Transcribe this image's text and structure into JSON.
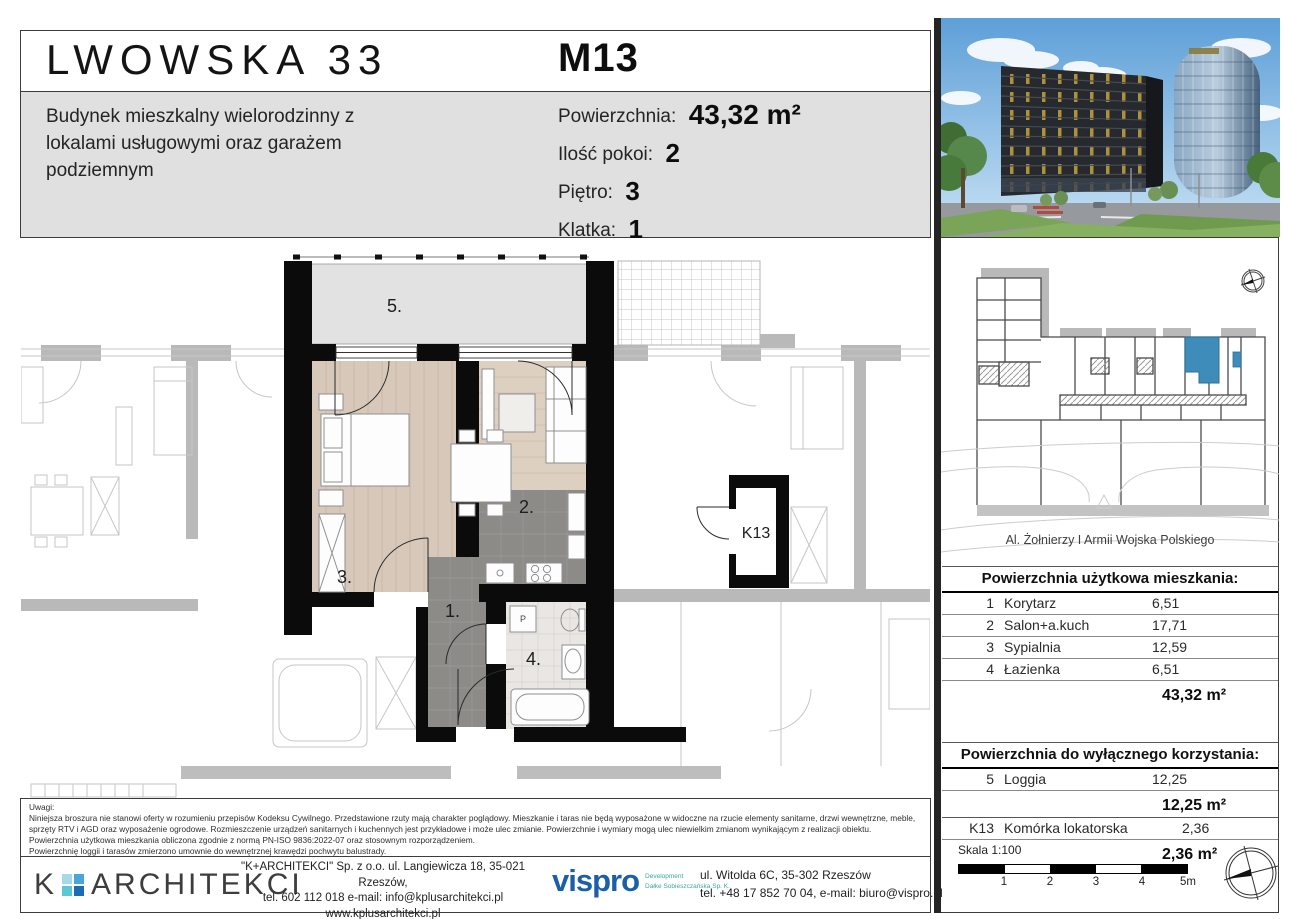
{
  "header": {
    "project_title": "LWOWSKA 33",
    "subtitle": "Budynek mieszkalny wielorodzinny z lokalami usługowymi oraz garażem podziemnym",
    "unit_id": "M13",
    "specs": [
      {
        "label": "Powierzchnia:",
        "value": "43,32 m²"
      },
      {
        "label": "Ilość pokoi:",
        "value": "2"
      },
      {
        "label": "Piętro:",
        "value": "3"
      },
      {
        "label": "Klatka:",
        "value": "1"
      }
    ]
  },
  "floor_plan": {
    "room_labels": {
      "r1": "1.",
      "r2": "2.",
      "r3": "3.",
      "r4": "4.",
      "r5": "5.",
      "k13": "K13"
    },
    "washer_mark": "P"
  },
  "key_plan": {
    "street_label": "Al. Żołnierzy I Armii Wojska Polskiego",
    "highlight_color": "#3e8cba"
  },
  "area_table_main": {
    "title": "Powierzchnia użytkowa mieszkania:",
    "rows": [
      {
        "no": "1",
        "name": "Korytarz",
        "area": "6,51"
      },
      {
        "no": "2",
        "name": "Salon+a.kuch",
        "area": "17,71"
      },
      {
        "no": "3",
        "name": "Sypialnia",
        "area": "12,59"
      },
      {
        "no": "4",
        "name": "Łazienka",
        "area": "6,51"
      }
    ],
    "total": "43,32 m²"
  },
  "area_table_exclusive": {
    "title": "Powierzchnia do wyłącznego korzystania:",
    "rows": [
      {
        "no": "5",
        "name": "Loggia",
        "area": "12,25",
        "subtotal": "12,25 m²"
      },
      {
        "no": "K13",
        "name": "Komórka lokatorska",
        "area": "2,36",
        "subtotal": "2,36 m²"
      }
    ]
  },
  "notes": {
    "title": "Uwagi:",
    "p1": "Niniejsza broszura nie stanowi oferty w rozumieniu przepisów Kodeksu Cywilnego. Przedstawione rzuty mają charakter poglądowy. Mieszkanie i taras nie będą wyposażone w widoczne na rzucie elementy sanitarne, drzwi wewnętrzne, meble, sprzęty RTV i AGD oraz wyposażenie ogrodowe. Rozmieszczenie urządzeń sanitarnych i kuchennych jest przykładowe i może ulec zmianie. Powierzchnie i wymiary mogą ulec niewielkim zmianom wynikającym z realizacji obiektu. Powierzchnia użytkowa mieszkania obliczona zgodnie z normą PN-ISO 9836:2022-07 oraz stosownym rozporządzeniem.",
    "p2": "Powierzchnię loggii i tarasów zmierzono umownie do wewnętrznej krawędzi pochwytu balustrady.",
    "p3": "Niniejsza wizualizacja budynku nie stanowi oferty w rozumieniu przepisów Kodeksu Cywilnego. Przedstawiona wizualizacja ma charakter poglądowy, wygląd budynku i przyjęte rozwiązania techniczne mogą ulec niewielkim zmianom wynikającym z realizacji obiektu."
  },
  "footer": {
    "architect_logo_k": "K",
    "architect_logo_name": "ARCHITEKCI",
    "architect_line1": "\"K+ARCHITEKCI\" Sp. z o.o. ul. Langiewicza 18, 35-021 Rzeszów,",
    "architect_line2": "tel. 602 112 018 e-mail: info@kplusarchitekci.pl",
    "architect_line3": "www.kplusarchitekci.pl",
    "developer_logo": "vispro",
    "developer_tagline1": "Development",
    "developer_tagline2": "Dałke Sobieszczańska Sp. K.",
    "developer_addr1": "ul. Witolda 6C, 35-302 Rzeszów",
    "developer_addr2": "tel. +48 17 852 70 04, e-mail: biuro@vispro.pl",
    "scale_label": "Skala 1:100",
    "scale_ticks": [
      "1",
      "2",
      "3",
      "4",
      "5m"
    ]
  }
}
